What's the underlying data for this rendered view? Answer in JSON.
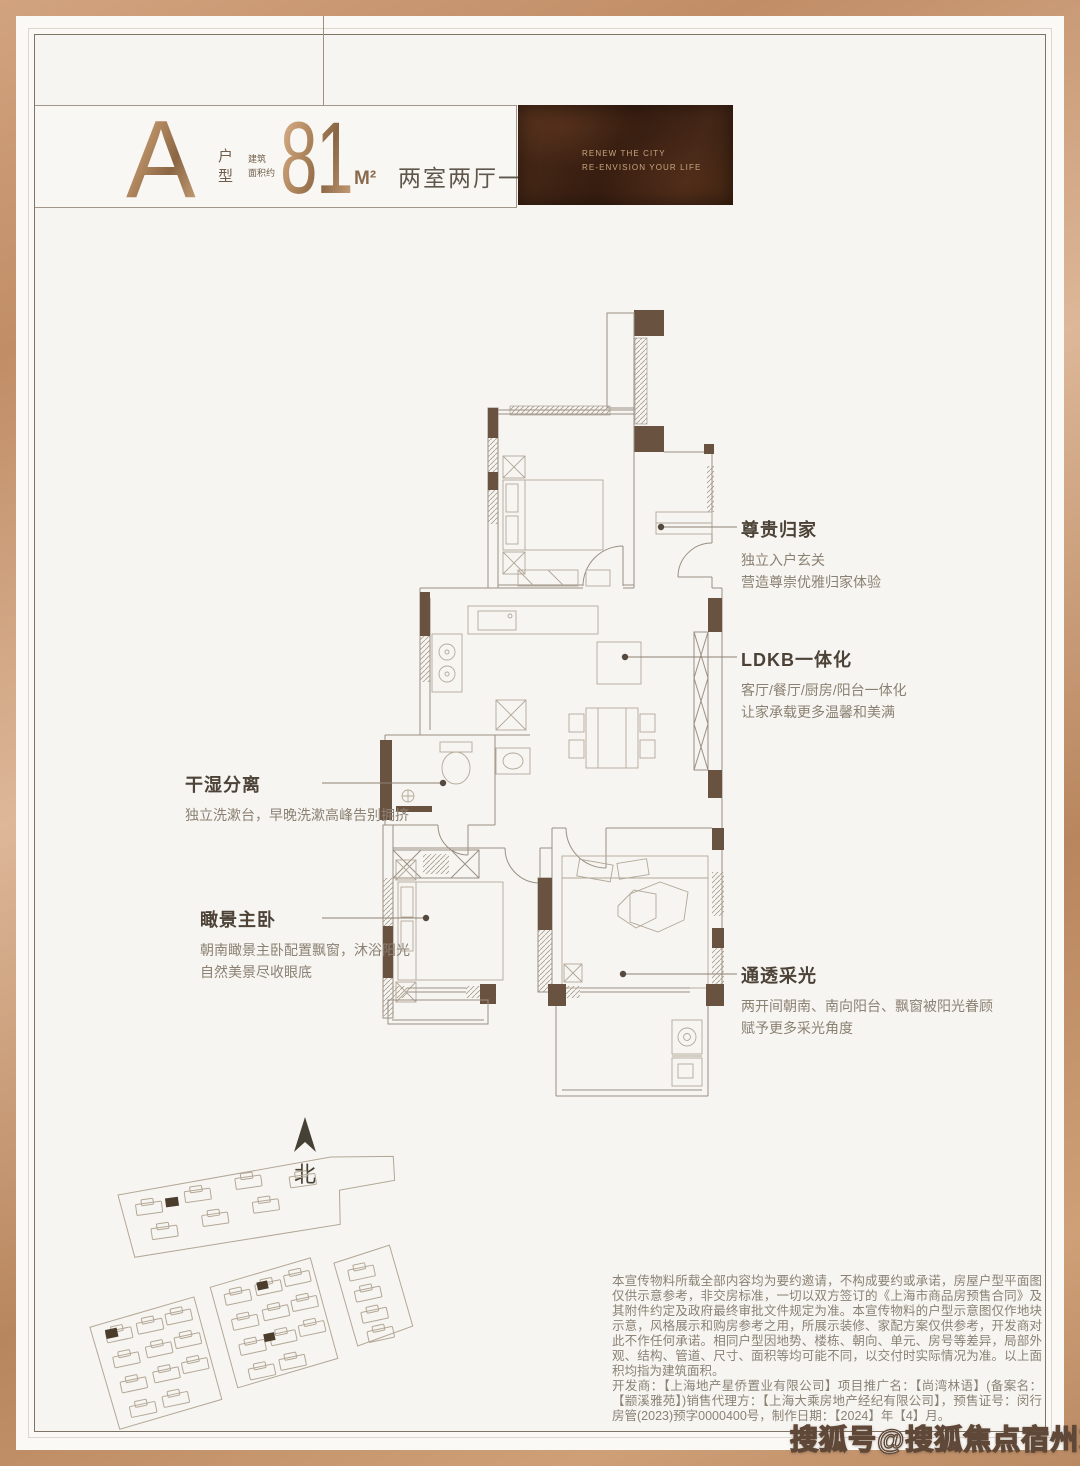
{
  "header": {
    "unit_letter": "A",
    "unit_label": "户型",
    "area_prefix": [
      "建筑",
      "面积约"
    ],
    "area_value": "81",
    "area_unit": "M²",
    "layout_desc": "两室两厅一卫"
  },
  "banner": {
    "line1": "RENEW THE CITY",
    "line2": "RE-ENVISION YOUR LIFE"
  },
  "callouts": [
    {
      "title": "尊贵归家",
      "lines": [
        "独立入户玄关",
        "营造尊崇优雅归家体验"
      ]
    },
    {
      "title": "LDKB一体化",
      "lines": [
        "客厅/餐厅/厨房/阳台一体化",
        "让家承载更多温馨和美满"
      ]
    },
    {
      "title": "干湿分离",
      "lines": [
        "独立洗漱台，早晚洗漱高峰告别拥挤"
      ]
    },
    {
      "title": "瞰景主卧",
      "lines": [
        "朝南瞰景主卧配置飘窗，沐浴阳光",
        "自然美景尽收眼底"
      ]
    },
    {
      "title": "通透采光",
      "lines": [
        "两开间朝南、南向阳台、飘窗被阳光眷顾",
        "赋予更多采光角度"
      ]
    }
  ],
  "compass": {
    "label": "北"
  },
  "disclaimer": {
    "para1": "本宣传物料所载全部内容均为要约邀请，不构成要约或承诺，房屋户型平面图仅供示意参考，非交房标准，一切以双方签订的《上海市商品房预售合同》及其附件约定及政府最终审批文件规定为准。本宣传物料的户型示意图仅作地块示意，风格展示和购房参考之用，所展示装修、家配方案仅供参考，开发商对此不作任何承诺。相同户型因地势、楼栋、朝向、单元、房号等差异，局部外观、结构、管道、尺寸、面积等均可能不同，以交付时实际情况为准。以上面积均指为建筑面积。",
    "para2": "开发商：【上海地产星侨置业有限公司】项目推广名：【尚湾林语】(备案名：【颛溪雅苑】)销售代理方：【上海大乘房地产经纪有限公司】，预售证号：闵行房管(2023)预字0000400号，制作日期：【2024】年【4】月。"
  },
  "watermark": {
    "text": "搜狐号@搜狐焦点宿州站"
  },
  "colors": {
    "frame_copper": "#c49772",
    "accent_copper": "#a2794f",
    "banner_bg": "#3f2415",
    "banner_text": "#c8a67e",
    "wall_dark": "#6a5240",
    "plan_line": "#9b9084",
    "callout_title": "#4c4237",
    "callout_body": "#8b8173",
    "disclaimer_text": "#8b8275",
    "watermark_outline": "#5f4838"
  }
}
